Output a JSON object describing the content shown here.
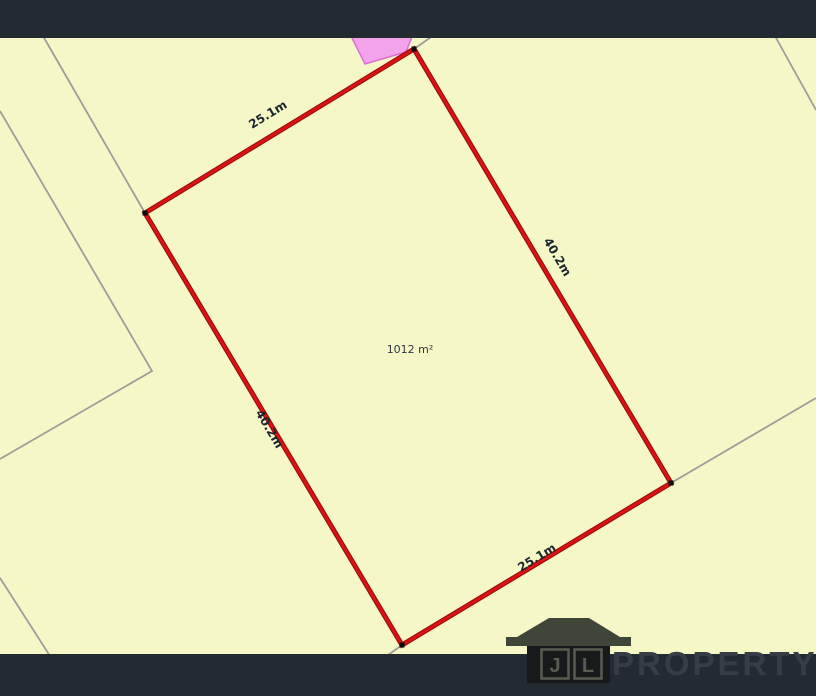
{
  "map": {
    "parcel": {
      "area_label": "1012 m²",
      "dimension_top": "25.1m",
      "dimension_right": "40.2m",
      "dimension_left": "40.2m",
      "dimension_bottom": "25.1m",
      "area_m2": 1012,
      "frontage_m": 25.1,
      "depth_m": 40.2
    },
    "colors": {
      "background": "#f5f7c6",
      "parcel_boundary": "#df1212",
      "parcel_boundary_edge": "#9c0d0d",
      "neighbor_lines": "#9d9d99",
      "overlay_pink_fill": "#f2a3e9",
      "overlay_pink_stroke": "#dd6bd8",
      "vertex_marker": "#0b0b0b",
      "letterbox_bar": "#242a31"
    }
  },
  "logo": {
    "initial_j": "J",
    "initial_l": "L",
    "wordmark": "PROPERTY"
  }
}
